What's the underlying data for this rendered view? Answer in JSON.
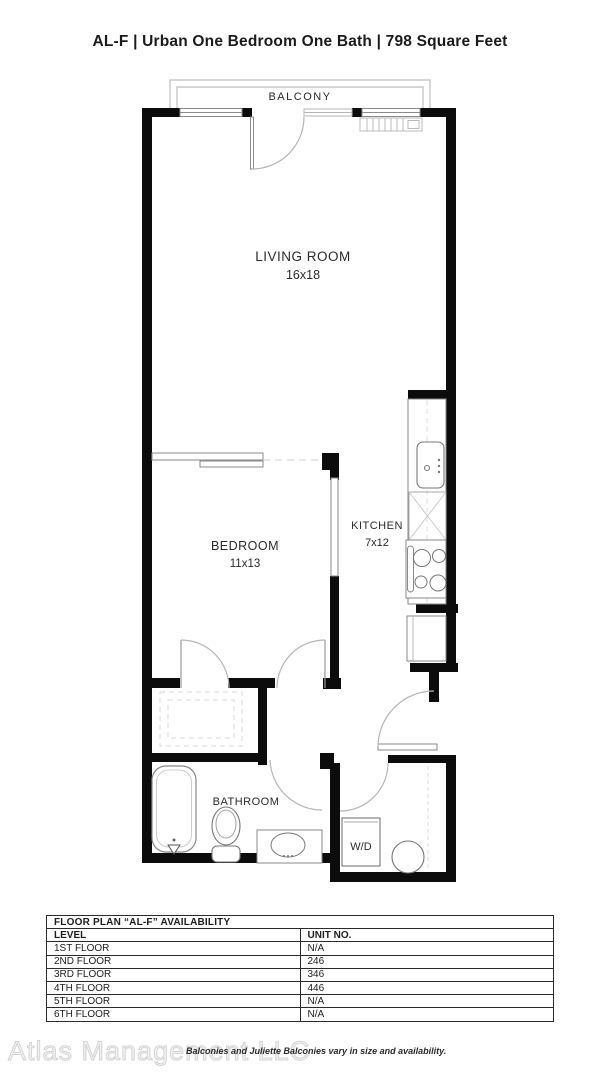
{
  "title": "AL-F | Urban One Bedroom One Bath | 798 Square Feet",
  "floor_plan": {
    "balcony_label": "BALCONY",
    "living_room": {
      "name": "LIVING ROOM",
      "dims": "16x18"
    },
    "bedroom": {
      "name": "BEDROOM",
      "dims": "11x13"
    },
    "kitchen": {
      "name": "KITCHEN",
      "dims": "7x12"
    },
    "bathroom": {
      "name": "BATHROOM"
    },
    "washer_dryer": {
      "name": "W/D"
    }
  },
  "availability_table": {
    "title": "FLOOR PLAN “AL-F” AVAILABILITY",
    "columns": [
      "LEVEL",
      "UNIT NO."
    ],
    "rows": [
      {
        "level": "1ST FLOOR",
        "unit": "N/A"
      },
      {
        "level": "2ND FLOOR",
        "unit": "246"
      },
      {
        "level": "3RD FLOOR",
        "unit": "346"
      },
      {
        "level": "4TH FLOOR",
        "unit": "446"
      },
      {
        "level": "5TH FLOOR",
        "unit": "N/A"
      },
      {
        "level": "6TH FLOOR",
        "unit": "N/A"
      }
    ]
  },
  "footer": {
    "watermark": "Atlas Management LLC",
    "disclaimer": "Balconies and Juliette Balconies vary in size and availability."
  },
  "colors": {
    "wall": "#0c0c0c",
    "fixture_line": "#8a8a8a",
    "light_line": "#c8c8c8",
    "text": "#2b2b2b"
  }
}
